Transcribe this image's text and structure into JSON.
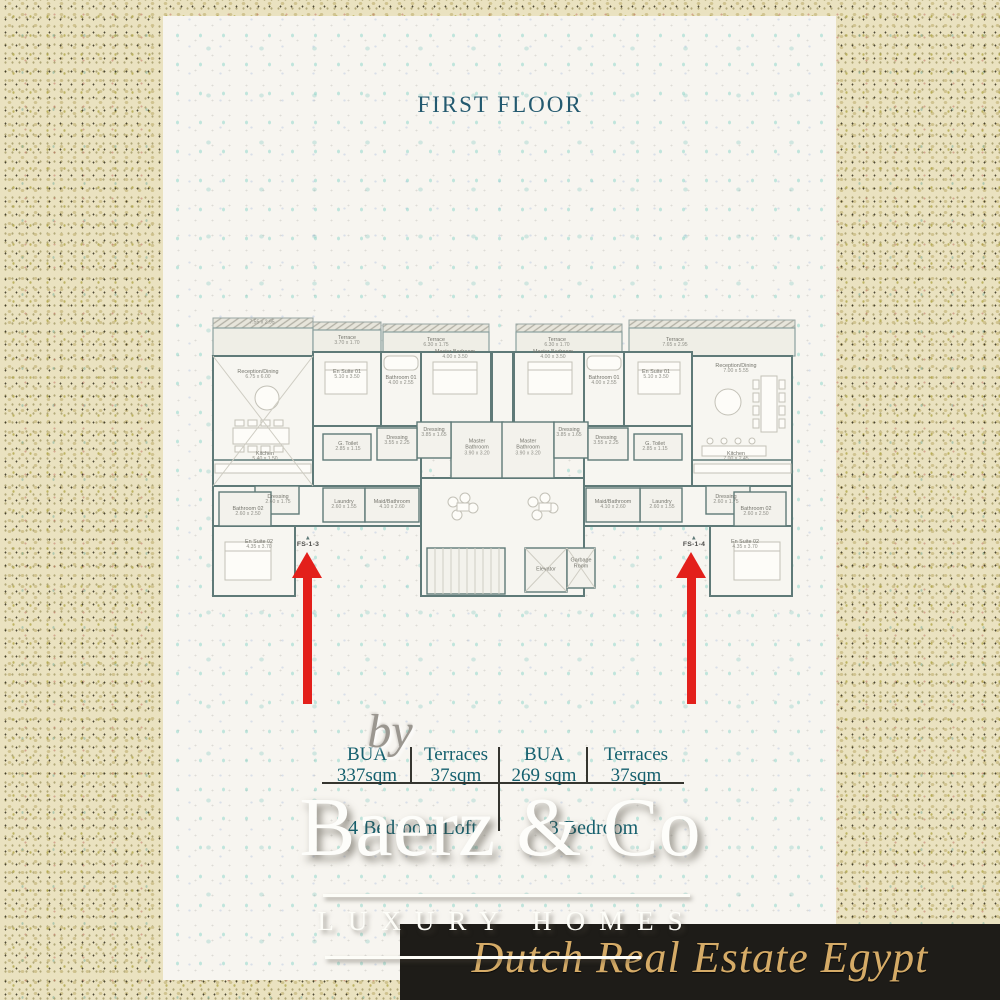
{
  "title": "FIRST FLOOR",
  "plan": {
    "rooms": [
      {
        "name": "",
        "dims": "7.55 x 2.95"
      },
      {
        "name": "Reception/Dining",
        "dims": "6.75 x 6.00"
      },
      {
        "name": "Terrace",
        "dims": "3.70 x 1.70"
      },
      {
        "name": "En Suite 01",
        "dims": "5.10 x 3.50"
      },
      {
        "name": "Bathroom 01",
        "dims": "4.00 x 2.55"
      },
      {
        "name": "Terrace",
        "dims": "6.30 x 1.75"
      },
      {
        "name": "Master Bedroom",
        "dims": "4.00 x 3.50"
      },
      {
        "name": "Kitchen",
        "dims": "5.40 x 1.50"
      },
      {
        "name": "G. Toilet",
        "dims": "2.85 x 1.15"
      },
      {
        "name": "Dressing",
        "dims": "3.55 x 2.25"
      },
      {
        "name": "Dressing",
        "dims": "3.85 x 1.65"
      },
      {
        "name": "Master Bathroom",
        "dims": "3.90 x 3.20"
      },
      {
        "name": "Dressing",
        "dims": "2.60 x 1.75"
      },
      {
        "name": "Bathroom 02",
        "dims": "2.60 x 2.50"
      },
      {
        "name": "En Suite 02",
        "dims": "4.35 x 3.70"
      },
      {
        "name": "Laundry",
        "dims": "2.60 x 1.55"
      },
      {
        "name": "Maid/Bathroom",
        "dims": "4.10 x 2.60"
      },
      {
        "name": "Elevator",
        "dims": ""
      },
      {
        "name": "Garbage Room",
        "dims": ""
      },
      {
        "name": "Terrace",
        "dims": "6.30 x 1.70"
      },
      {
        "name": "Master Bedroom",
        "dims": "4.00 x 3.50"
      },
      {
        "name": "Bathroom 01",
        "dims": "4.00 x 2.55"
      },
      {
        "name": "En Suite 01",
        "dims": "5.10 x 3.50"
      },
      {
        "name": "Terrace",
        "dims": "7.65 x 2.95"
      },
      {
        "name": "Reception/Dining",
        "dims": "7.00 x 5.55"
      },
      {
        "name": "Master Bathroom",
        "dims": "3.90 x 3.20"
      },
      {
        "name": "Dressing",
        "dims": "3.85 x 1.65"
      },
      {
        "name": "Dressing",
        "dims": "3.55 x 2.25"
      },
      {
        "name": "G. Toilet",
        "dims": "2.85 x 1.15"
      },
      {
        "name": "Kitchen",
        "dims": "7.00 x 2.45"
      },
      {
        "name": "Maid/Bathroom",
        "dims": "4.10 x 2.60"
      },
      {
        "name": "Laundry",
        "dims": "2.60 x 1.55"
      },
      {
        "name": "Dressing",
        "dims": "2.60 x 1.75"
      },
      {
        "name": "Bathroom 02",
        "dims": "2.60 x 2.50"
      },
      {
        "name": "En Suite 02",
        "dims": "4.35 x 3.70"
      }
    ],
    "markers": [
      {
        "label": "FS-1-3"
      },
      {
        "label": "FS-1-4"
      }
    ]
  },
  "stats": {
    "left": {
      "bua_label": "BUA",
      "bua_value": "337sqm",
      "terraces_label": "Terraces",
      "terraces_value": "37sqm",
      "unit_type": "4 Bedroom Loft"
    },
    "right": {
      "bua_label": "BUA",
      "bua_value": "269 sqm",
      "terraces_label": "Terraces",
      "terraces_value": "37sqm",
      "unit_type": "3 Bedroom"
    }
  },
  "branding": {
    "by": "by",
    "name": "Baerz & Co",
    "tagline": "LUXURY HOMES",
    "banner": "Dutch Real Estate Egypt"
  },
  "colors": {
    "title": "#23596f",
    "stats_text": "#15606e",
    "wall": "#5f7a78",
    "arrow_red": "#e3201b",
    "banner_bg": "#1e1c18",
    "banner_gold": "#d5ab67"
  }
}
